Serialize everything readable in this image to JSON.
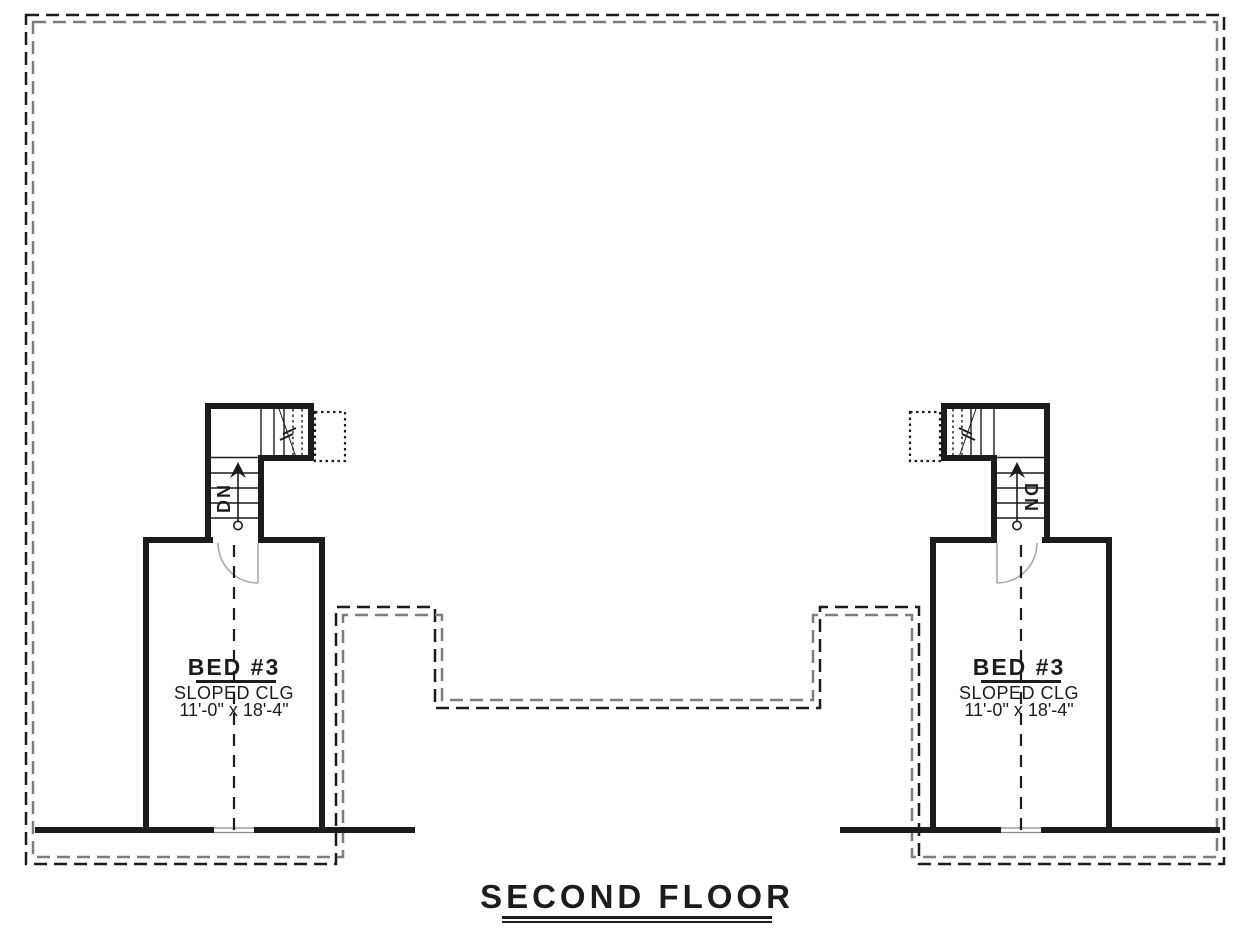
{
  "drawing": {
    "title": "SECOND FLOOR"
  },
  "units": {
    "left": {
      "room_name": "BED #3",
      "ceiling_note": "SLOPED CLG",
      "room_size": "11'-0\" x 18'-4\"",
      "stair_direction": "DN"
    },
    "right": {
      "room_name": "BED #3",
      "ceiling_note": "SLOPED CLG",
      "room_size": "11'-0\" x 18'-4\"",
      "stair_direction": "DN"
    }
  },
  "colors": {
    "wall_line": "#1c1c1c",
    "roof_dash_outer": "#1c1c1c",
    "roof_dash_inner": "#7d7d7d",
    "door_swing": "#aaaaaa",
    "window_line": "#8a8a8a",
    "background": "#ffffff"
  }
}
